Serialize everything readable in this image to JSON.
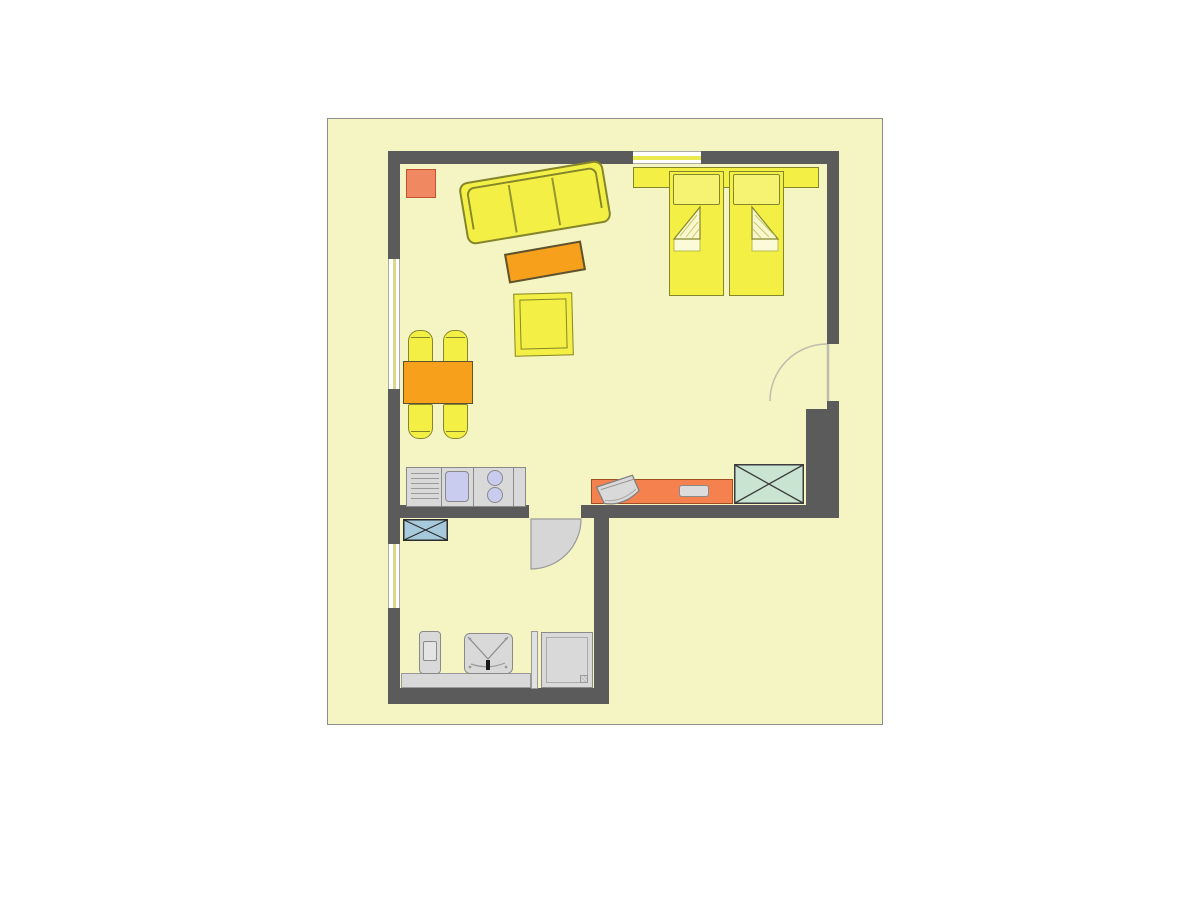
{
  "page": {
    "background": "#FFFFFF"
  },
  "plan": {
    "type": "apartment-floor-plan",
    "visible_text": [],
    "rooms": [
      "living-bedroom",
      "kitchenette-area",
      "hall-bathroom"
    ],
    "items": [
      "outer-walls",
      "window-left-upper",
      "window-left-lower",
      "window-top",
      "entry-door-swing",
      "interior-door-swing",
      "sofa-three-seat",
      "coffee-table",
      "armchair",
      "side-table",
      "double-bed-headboard",
      "mattress-left",
      "mattress-right",
      "pillows",
      "folded-duvet-corners",
      "dining-table",
      "dining-chairs-x4",
      "kitchen-counter",
      "drainboard",
      "sink",
      "stove-two-burners",
      "sideboard",
      "tv-set",
      "remote-tray",
      "wardrobe-crossed-green",
      "laundry-crossed-blue",
      "bath-shelf",
      "toilet",
      "washbasin",
      "shower-partition",
      "shower-tray"
    ],
    "colors": {
      "plan_bg": "#F5F5C3",
      "plan_border": "#8C8C8C",
      "wall": "#5B5B5B",
      "yellow": "#F3EF44",
      "yellow_light": "#F6F373",
      "olive": "#85862B",
      "orange": "#F7A01C",
      "orange_border": "#5C5430",
      "salmon": "#F08962",
      "salmon_border": "#C2532E",
      "desk_orange": "#F4814E",
      "desk_border": "#A04E22",
      "green_box": "#C9E4D1",
      "blue_box": "#A6C9DB",
      "cross": "#3D3D3D",
      "fixture": "#D9D9D9",
      "fixture_border": "#8A8A8A",
      "lavender": "#C9CBEF",
      "door_fill": "#D6D6D6",
      "door_stroke": "#9A9A9A",
      "arc_stroke": "#BDBDAD",
      "window_line_v": "#D8D88A",
      "window_line_h": "#E9E94E",
      "fold_fill": "#F8F7CF",
      "fold_line": "#C9CB62"
    }
  }
}
